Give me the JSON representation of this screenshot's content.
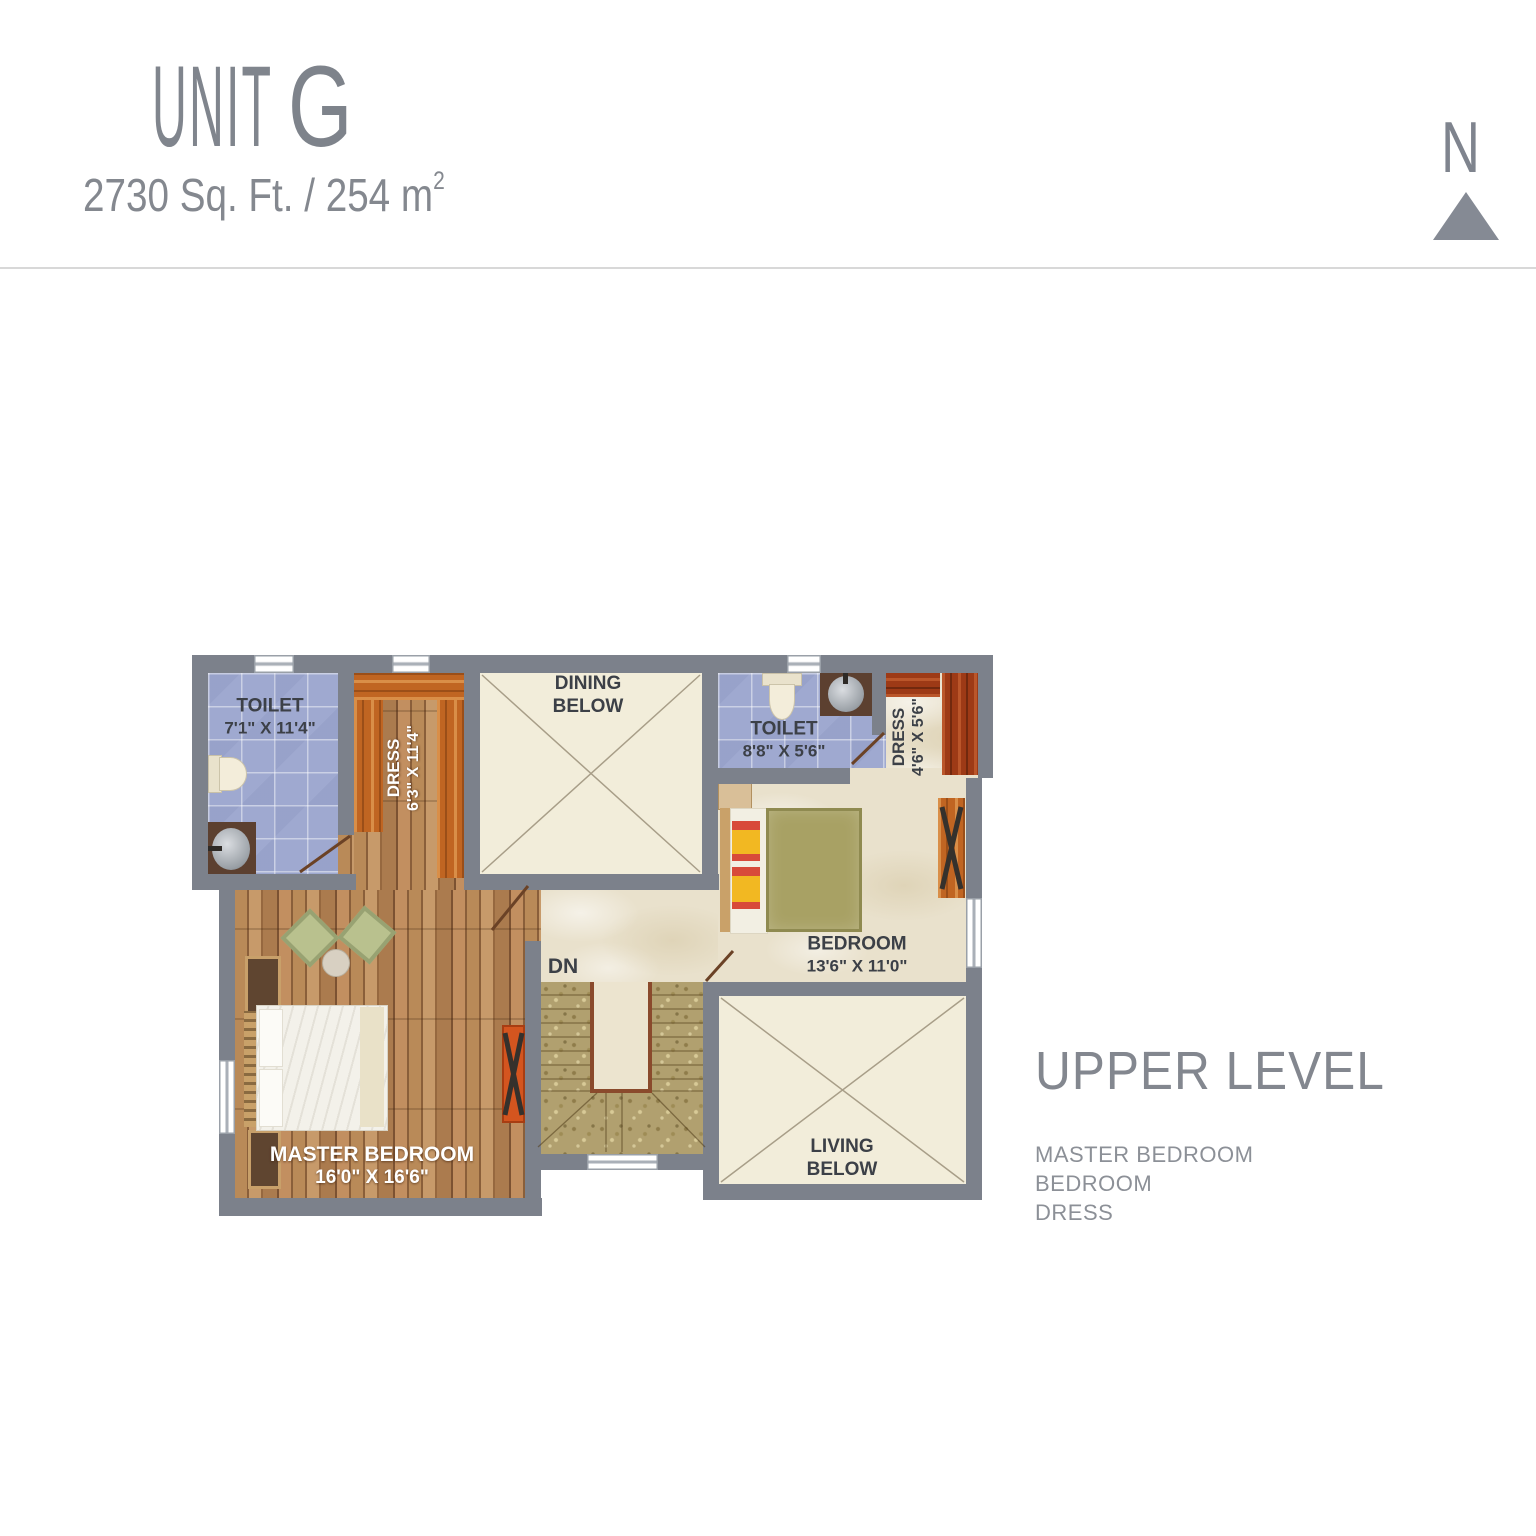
{
  "header": {
    "title_word": "UNIT",
    "title_letter": "G",
    "area_text": "2730 Sq. Ft. / 254 m",
    "area_sup": "2"
  },
  "compass": {
    "label": "N"
  },
  "plan": {
    "rooms": {
      "toilet1": {
        "name": "TOILET",
        "dims": "7'1\" X 11'4\""
      },
      "dress1": {
        "name": "DRESS",
        "dims": "6'3\" X 11'4\""
      },
      "dining": {
        "line1": "DINING",
        "line2": "BELOW"
      },
      "toilet2": {
        "name": "TOILET",
        "dims": "8'8\" X 5'6\""
      },
      "dress2": {
        "name": "DRESS",
        "dims": "4'6\" X 5'6\""
      },
      "bedroom": {
        "name": "BEDROOM",
        "dims": "13'6\" X 11'0\""
      },
      "master": {
        "name": "MASTER BEDROOM",
        "dims": "16'0\" X 16'6\""
      },
      "living": {
        "line1": "LIVING",
        "line2": "BELOW"
      },
      "stairs": {
        "label": "DN"
      }
    }
  },
  "legend": {
    "title": "UPPER LEVEL",
    "items": [
      "MASTER BEDROOM",
      "BEDROOM",
      "DRESS"
    ]
  },
  "colors": {
    "wall": "#7c818b",
    "tile_blue": "#9fa9d0",
    "wood_floor": "#a8784c",
    "wardrobe_orange": "#c06522",
    "wardrobe_dark_red": "#9d3a16",
    "open_below_cream": "#f2edda",
    "marble_floor": "#e9e1cc",
    "stairs_granite": "#b1a06f",
    "label_dark": "#3c4047",
    "heading_gray": "#83878f"
  }
}
